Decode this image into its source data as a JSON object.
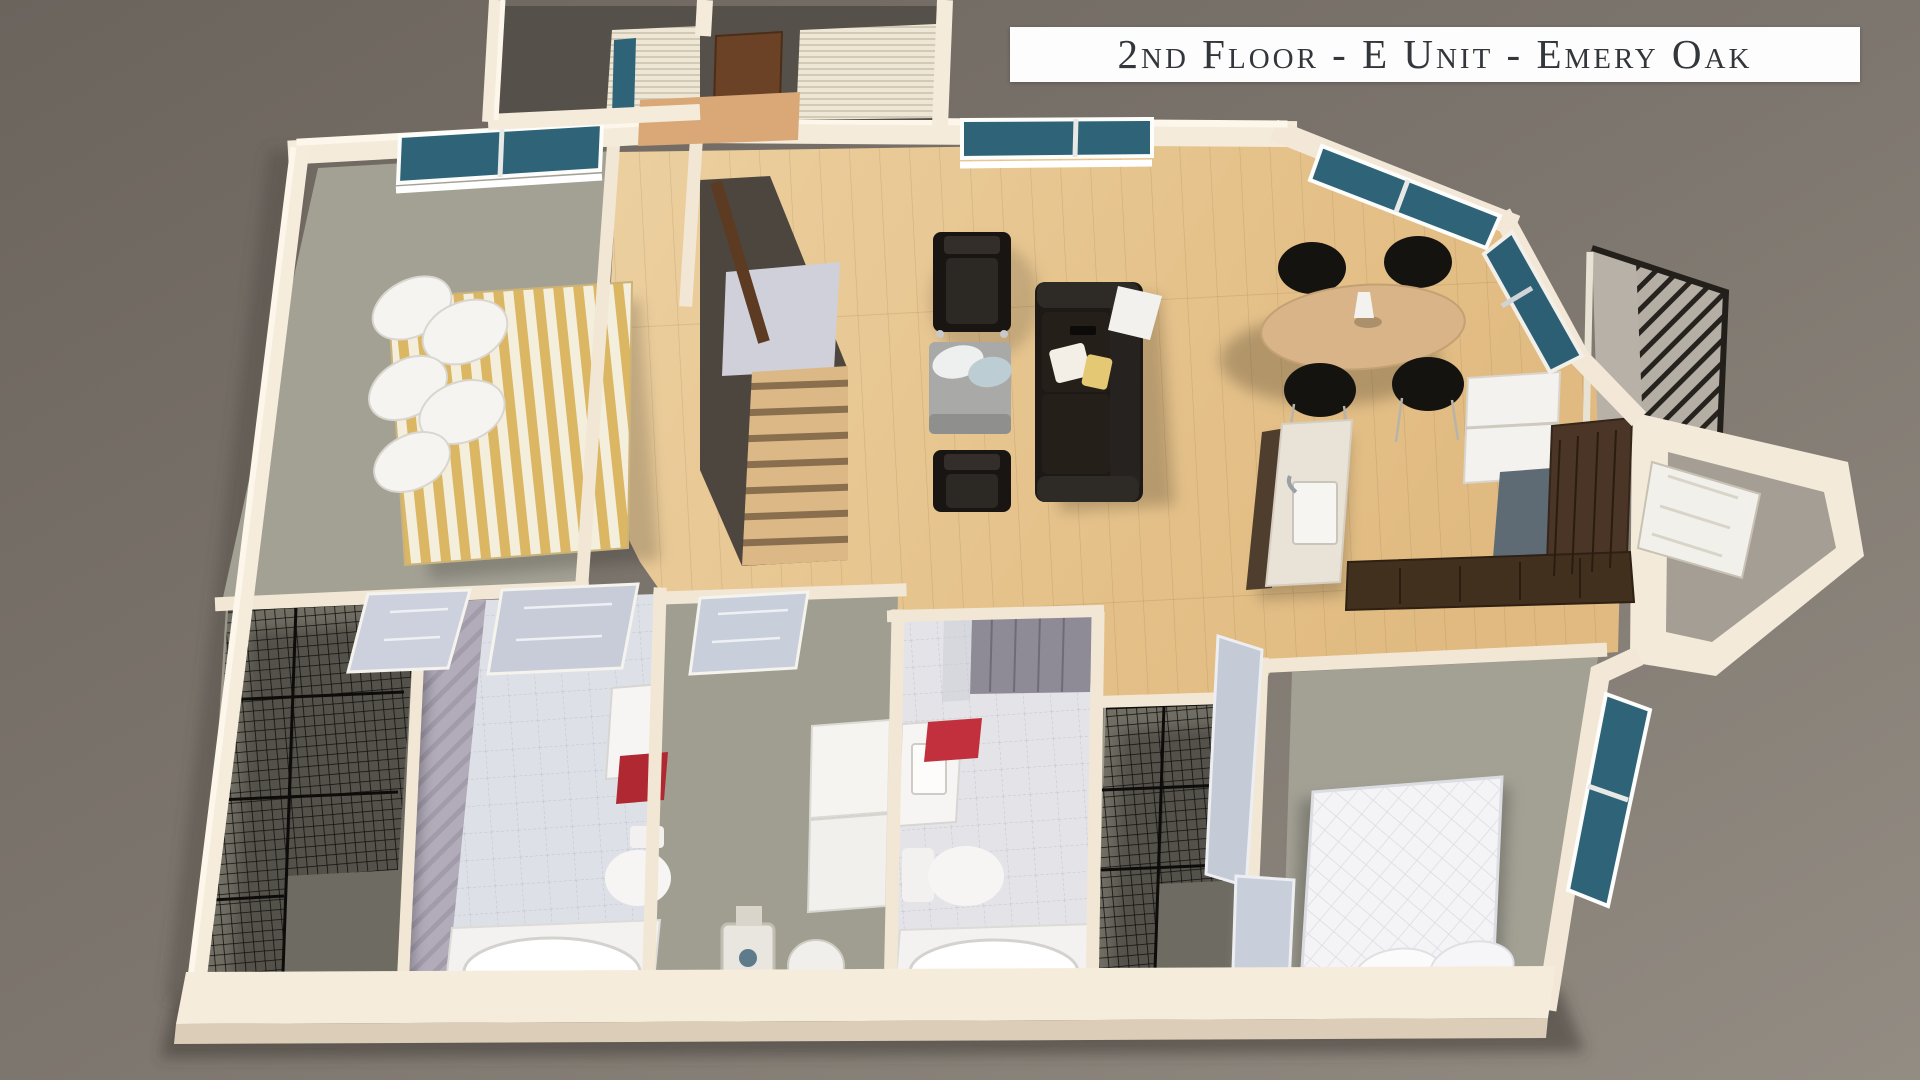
{
  "title_banner": {
    "text": "2nd Floor - E Unit - Emery Oak"
  },
  "scene": {
    "type": "3d-isometric-floorplan-render",
    "floor": "2nd Floor",
    "unit": "E Unit",
    "community": "Emery Oak",
    "rooms": [
      "master-bedroom",
      "stair-hall",
      "living-room",
      "dining-area",
      "kitchen",
      "balcony",
      "entry-vestibule",
      "bathroom-1",
      "bathroom-2",
      "laundry-room",
      "walk-in-closet-1",
      "walk-in-closet-2",
      "bedroom-2"
    ],
    "furniture": [
      "striped-bed",
      "white-pillows",
      "black-armchair",
      "black-armchair",
      "gray-ottoman",
      "black-leather-sofa",
      "oval-dining-table",
      "dining-chairs",
      "kitchen-island-with-sink",
      "refrigerator",
      "l-shaped-counter",
      "washer",
      "dryer",
      "water-heater",
      "bathtub",
      "toilet",
      "vanity-sink",
      "red-towel",
      "wire-shelving-rack",
      "white-quilted-bed",
      "stairs",
      "front-door"
    ]
  },
  "palette": {
    "background_top": "#6e6760",
    "background_bottom": "#918a81",
    "wall_cream": "#f4eadb",
    "wall_highlight": "#fdf7ec",
    "wall_shadow": "#d9cab6",
    "carpet_gray_green": "#a3a194",
    "wood_floor": "#e6c491",
    "tile_light": "#e0e0e6",
    "tile_lavender": "#b2acbd",
    "window_teal": "#2f6478",
    "furniture_black": "#1c1916",
    "accent_red": "#b02832",
    "cabinet_dark_wood": "#4a3829",
    "table_wood": "#d7b282",
    "railing_dark": "#23201c"
  }
}
